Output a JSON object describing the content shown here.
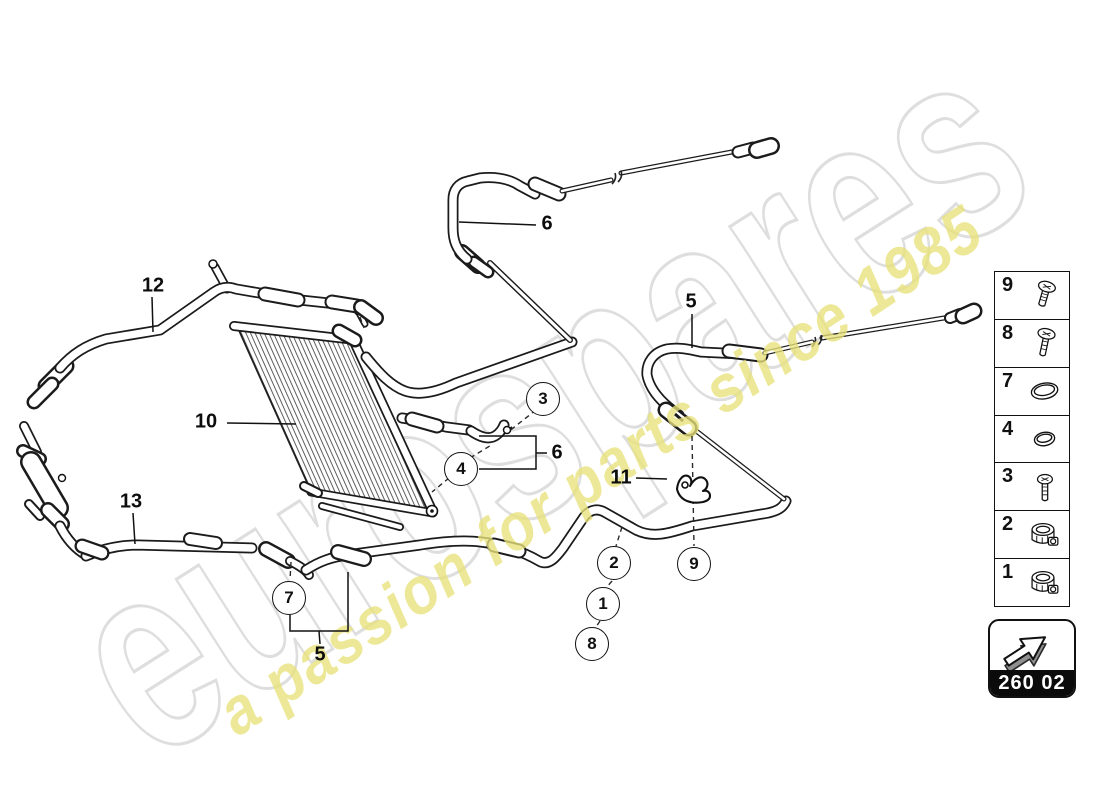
{
  "watermark": {
    "brand": "eurospares",
    "slogan": "a passion for parts since 1985",
    "brand_outline_color": "#dedede",
    "slogan_color": "#e9e27a"
  },
  "diagram": {
    "callouts": {
      "c1": "1",
      "c2": "2",
      "c3": "3",
      "c4": "4",
      "c7": "7",
      "c8": "8",
      "c9": "9"
    },
    "labels": {
      "l5a": "5",
      "l5b": "5",
      "l6a": "6",
      "l6b": "6",
      "l10": "10",
      "l11": "11",
      "l12": "12",
      "l13": "13"
    }
  },
  "legend": {
    "items": [
      {
        "number": "9",
        "icon": "flange-screw-icon"
      },
      {
        "number": "8",
        "icon": "flange-screw-icon"
      },
      {
        "number": "7",
        "icon": "o-ring-large-icon"
      },
      {
        "number": "4",
        "icon": "o-ring-small-icon"
      },
      {
        "number": "3",
        "icon": "screw-icon"
      },
      {
        "number": "2",
        "icon": "hose-clamp-icon"
      },
      {
        "number": "1",
        "icon": "hose-clamp-icon"
      }
    ]
  },
  "page_code": {
    "label": "260 02"
  }
}
